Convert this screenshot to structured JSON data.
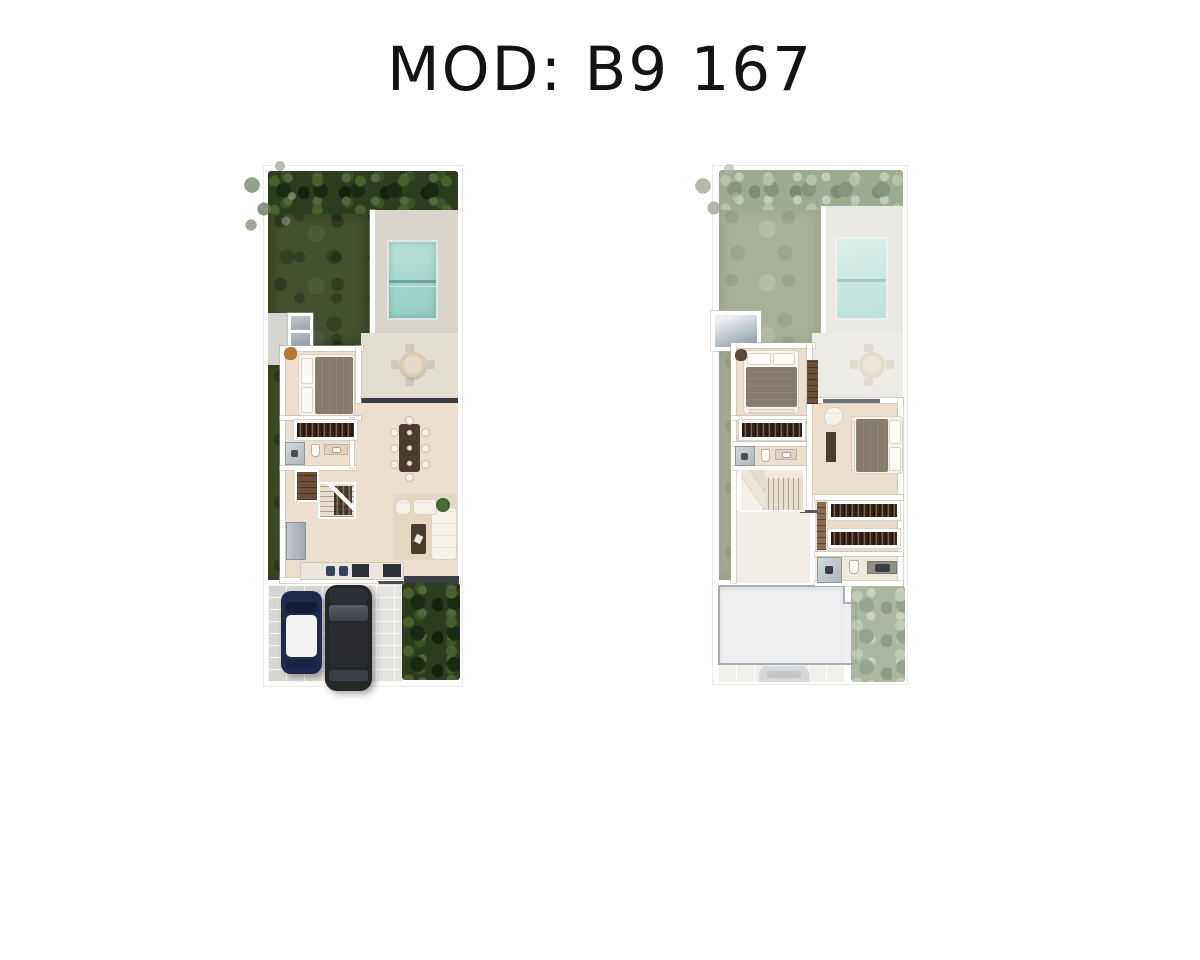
{
  "header": {
    "title": "MOD: B9 167"
  },
  "colors": {
    "title_color": "#131313",
    "page_bg": "#ffffff",
    "grass": "#42502e",
    "grass_faded": "#a9b098",
    "foliage": "#2d3b1f",
    "foliage_faded": "#9dab90",
    "pool": "#a6d8ce",
    "pool_faded": "#cfe8e3",
    "deck": "#d9d5cc",
    "deck_faded": "#eae8e3",
    "floor": "#ecdfcd",
    "floor_pale": "#f1ede6",
    "wood_dark": "#4b3c2e",
    "duvet_gray": "#857c6e",
    "counter_dark": "#2d3137",
    "stool_navy": "#36415f",
    "car_navy": "#1f2950",
    "car_black": "#242628",
    "paver_gray": "#d8d6d2",
    "roof_gray": "#edeff1",
    "porch_steel": "#93a2ae"
  },
  "plans": [
    {
      "name": "ground-floor-plan",
      "features": [
        "garden",
        "shrub-border",
        "tree-canopy",
        "swimming-pool",
        "pool-deck",
        "patio-table",
        "bedroom",
        "closet",
        "bathroom",
        "pantry",
        "stairs",
        "kitchen",
        "dining-table",
        "living-room-sofa",
        "entry-porch",
        "driveway",
        "car-compact-navy",
        "car-suv-black",
        "hedge"
      ]
    },
    {
      "name": "upper-floor-plan",
      "features": [
        "garden-below-faded",
        "pool-below-faded",
        "terrace-void",
        "bedroom-2",
        "closet-2",
        "bathroom-2",
        "stairs",
        "hallway",
        "master-bedroom",
        "walk-in-closet",
        "master-bathroom",
        "roof-slab",
        "driveway-below-faded",
        "tree-faded"
      ]
    }
  ]
}
